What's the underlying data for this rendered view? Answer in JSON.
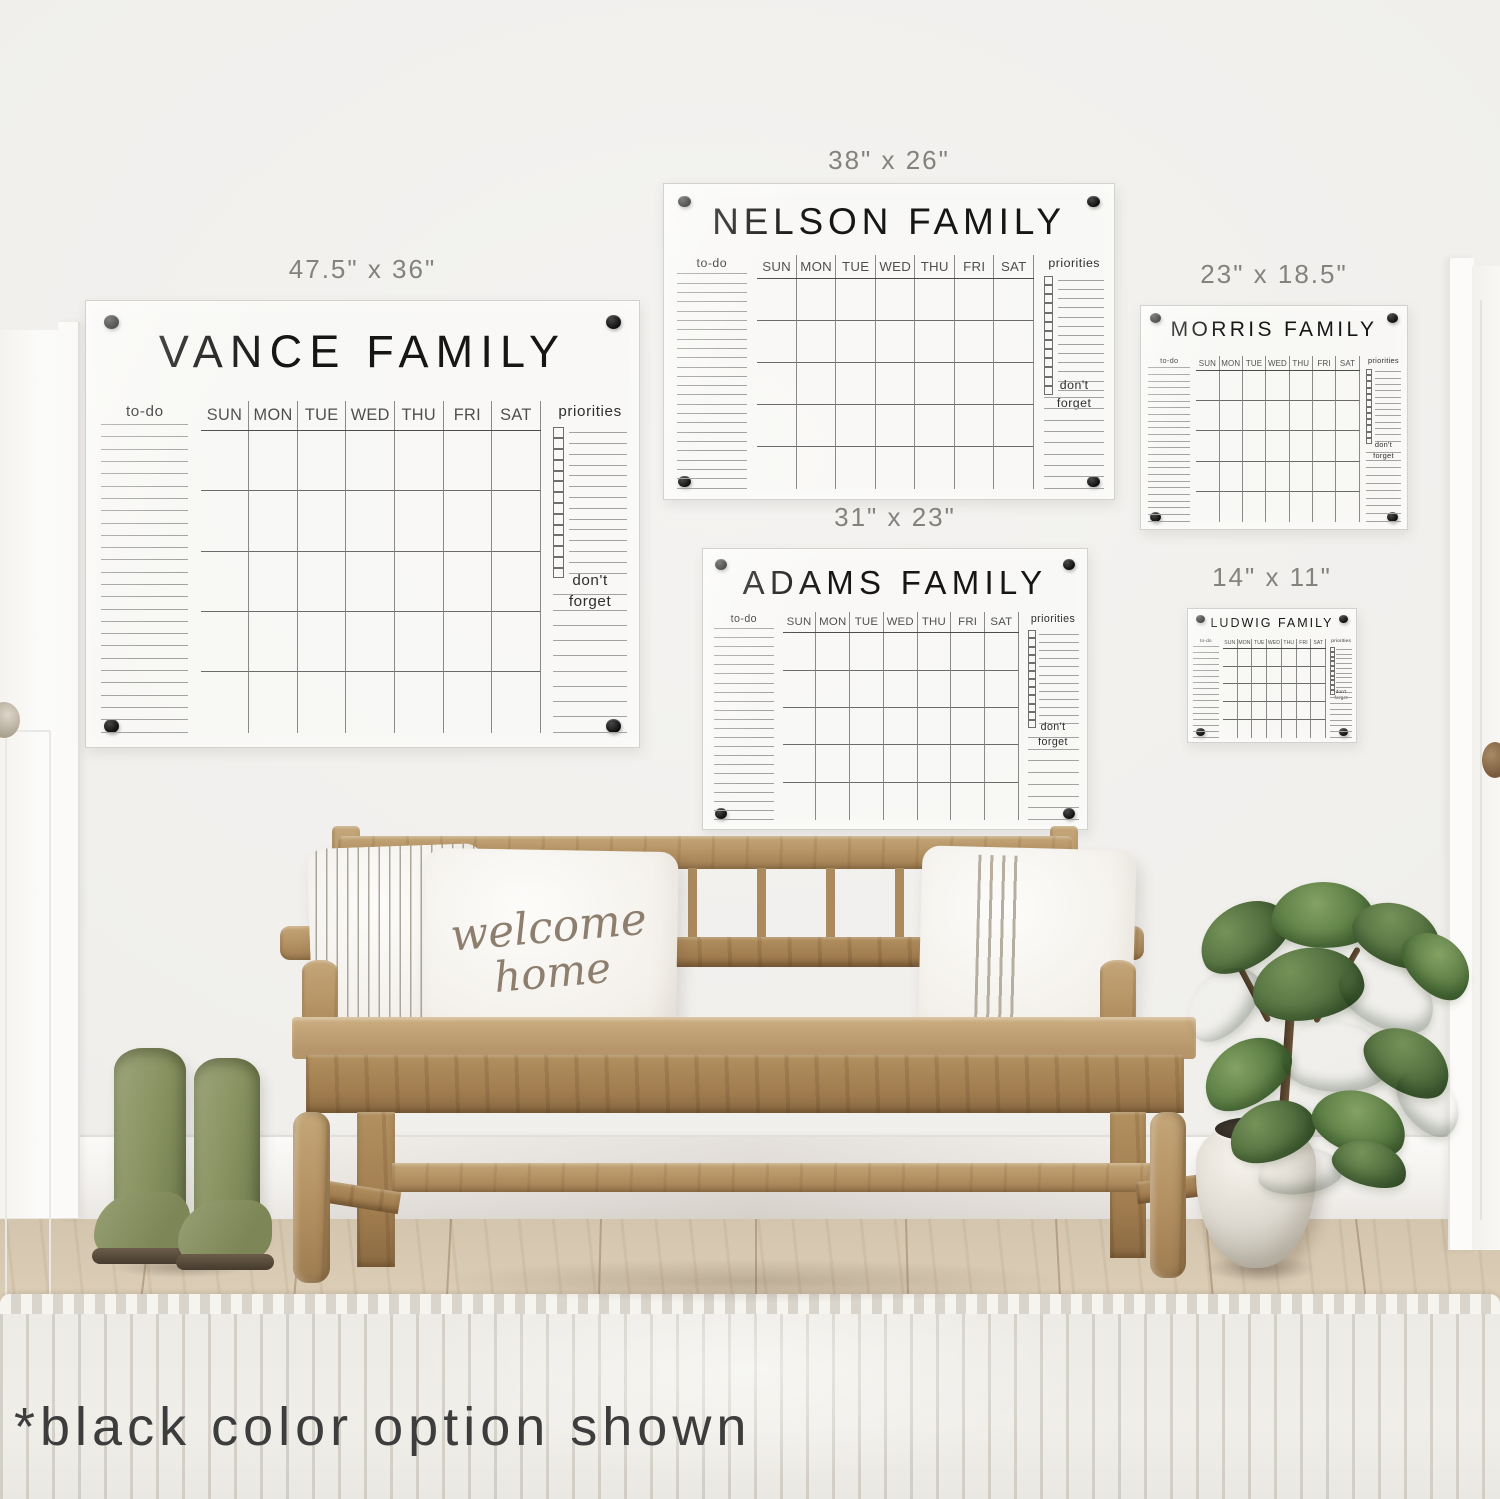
{
  "note_text": "*black color option shown",
  "pillow": {
    "line1": "welcome",
    "line2": "home"
  },
  "calendar_labels": {
    "todo": "to-do",
    "priorities": "priorities",
    "dont_forget": "don't forget",
    "days": [
      "SUN",
      "MON",
      "TUE",
      "WED",
      "THU",
      "FRI",
      "SAT"
    ]
  },
  "calendars": [
    {
      "id": "vance",
      "title": "VANCE FAMILY",
      "size_label": "47.5\" x 36\"",
      "grid_rows": 5,
      "todo_lines": 26,
      "priority_rows": 14,
      "dont_forget_lines": 10
    },
    {
      "id": "nelson",
      "title": "NELSON FAMILY",
      "size_label": "38\" x 26\"",
      "grid_rows": 5,
      "todo_lines": 24,
      "priority_rows": 13,
      "dont_forget_lines": 9
    },
    {
      "id": "morris",
      "title": "MORRIS FAMILY",
      "size_label": "23\" x 18.5\"",
      "grid_rows": 5,
      "todo_lines": 24,
      "priority_rows": 12,
      "dont_forget_lines": 10
    },
    {
      "id": "adams",
      "title": "ADAMS FAMILY",
      "size_label": "31\" x 23\"",
      "grid_rows": 5,
      "todo_lines": 22,
      "priority_rows": 12,
      "dont_forget_lines": 8
    },
    {
      "id": "ludwig",
      "title": "LUDWIG FAMILY",
      "size_label": "14\" x 11\"",
      "grid_rows": 5,
      "todo_lines": 16,
      "priority_rows": 10,
      "dont_forget_lines": 8
    }
  ],
  "colors": {
    "calendar_marker": "#1b1b1b",
    "size_label_text": "#85827d",
    "mounting_hardware": "#121212",
    "boots_olive": "#8b9166",
    "bench_wood": "#b3926a",
    "plant_leaf": "#597a43",
    "rug": "#edebe5"
  }
}
